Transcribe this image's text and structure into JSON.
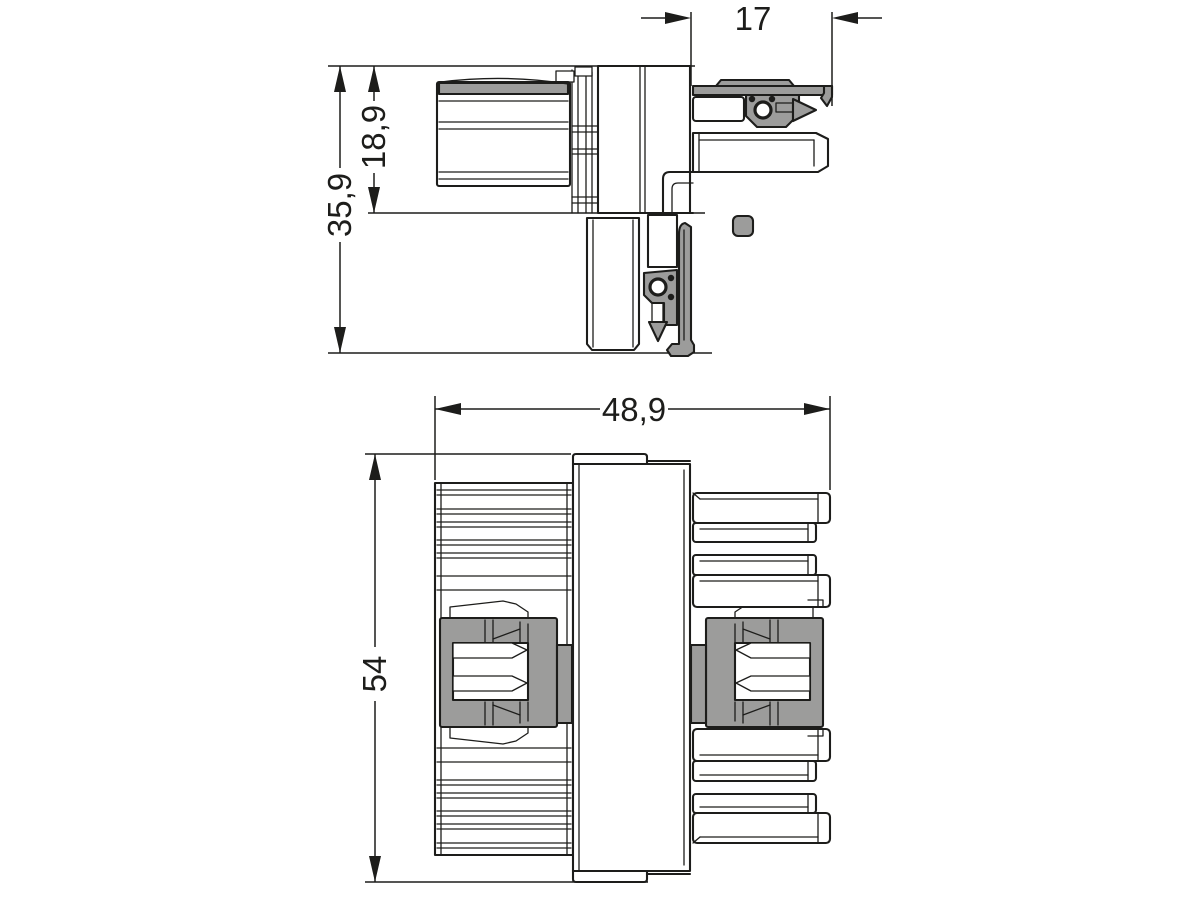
{
  "drawing": {
    "kind": "connector-dimension-drawing",
    "views": {
      "side": {
        "name": "side-view",
        "dims": {
          "arm_length": "17",
          "upper_height": "18,9",
          "total_height": "35,9"
        }
      },
      "front": {
        "name": "front-view",
        "dims": {
          "total_width": "48,9",
          "total_height": "54"
        }
      }
    }
  },
  "colors": {
    "line": "#1d1d1b",
    "gray": "#9c9c9b",
    "bg": "#ffffff"
  }
}
